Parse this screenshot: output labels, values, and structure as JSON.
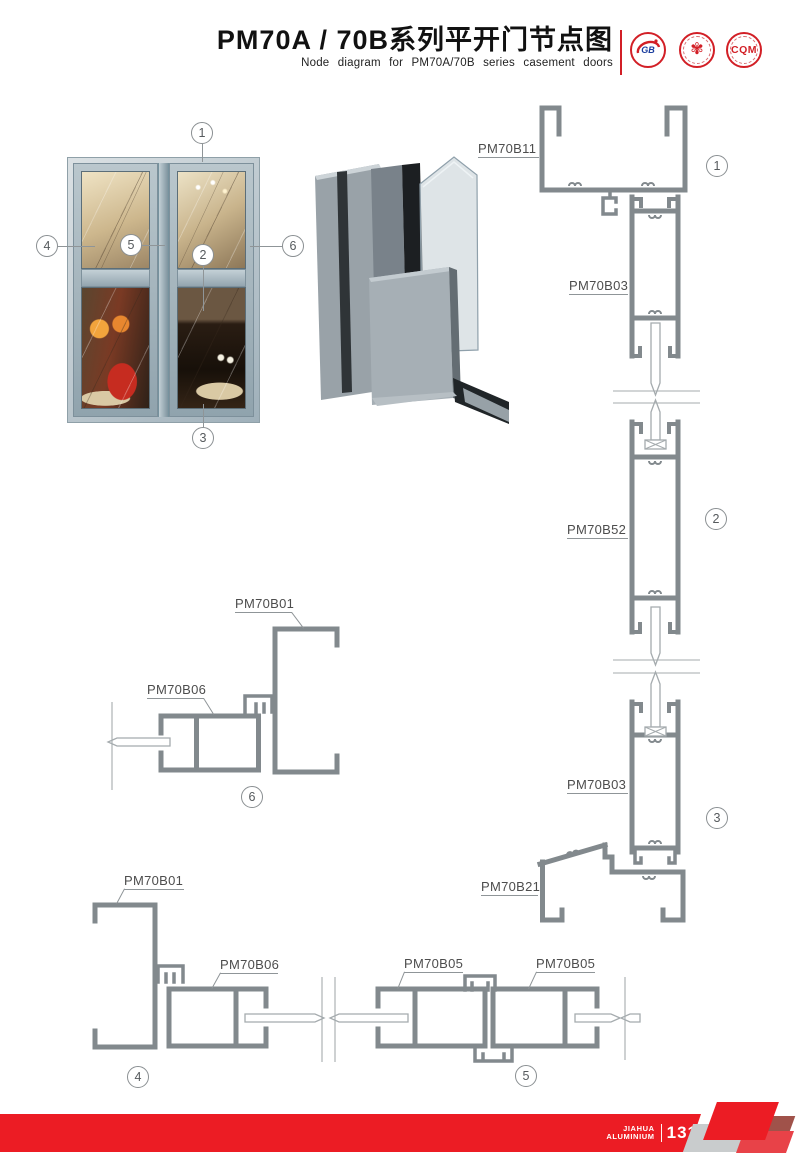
{
  "header": {
    "title": "PM70A / 70B系列平开门节点图",
    "subtitle": "Node diagram for PM70A/70B series casement doors",
    "logos": [
      {
        "name": "gb-certification-logo",
        "text": "GB"
      },
      {
        "name": "quality-certification-logo",
        "text": "✾"
      },
      {
        "name": "cqm-logo",
        "text": "CQM"
      }
    ]
  },
  "callouts": {
    "n1": "1",
    "n2": "2",
    "n3": "3",
    "n4": "4",
    "n5": "5",
    "n6": "6"
  },
  "labels": {
    "pm70b11": "PM70B11",
    "pm70b03_top": "PM70B03",
    "pm70b52": "PM70B52",
    "pm70b03_bottom": "PM70B03",
    "pm70b21": "PM70B21",
    "pm70b01_mid": "PM70B01",
    "pm70b06_mid": "PM70B06",
    "pm70b01_bottom": "PM70B01",
    "pm70b06_bottom": "PM70B06",
    "pm70b05_left": "PM70B05",
    "pm70b05_right": "PM70B05"
  },
  "footer": {
    "brand_line1": "JIAHUA",
    "brand_line2": "ALUMINIUM",
    "page_number": "131"
  },
  "colors": {
    "accent_red": "#ec1c24",
    "profile_gray": "#82898d"
  }
}
